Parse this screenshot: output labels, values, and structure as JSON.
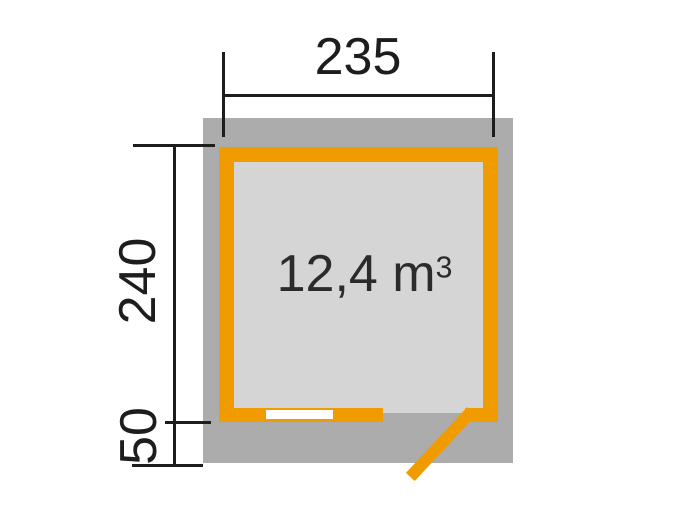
{
  "diagram": {
    "type": "floor-plan",
    "dimensions": {
      "width": "235",
      "depth": "240",
      "overhang": "50"
    },
    "volume": {
      "value": "12,4 m",
      "exponent": "3"
    },
    "colors": {
      "wall_orange": "#f09c00",
      "roof_overhang_gray": "#acacac",
      "interior_floor_gray": "#d5d5d5",
      "dimension_line_black": "#1d1d1b",
      "window_white": "#ffffff",
      "background": "#ffffff"
    }
  }
}
